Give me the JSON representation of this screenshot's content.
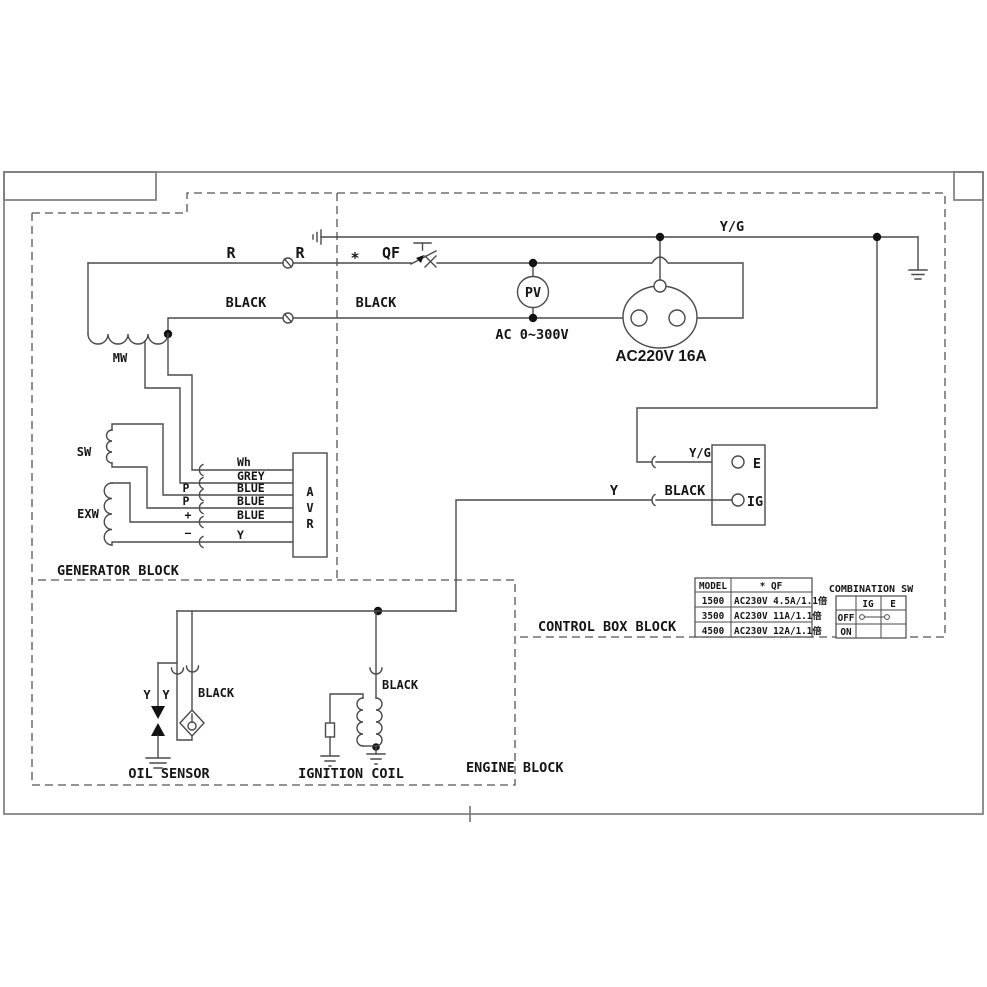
{
  "diagram": {
    "wire_labels": {
      "r_left": "R",
      "r_right": "R",
      "asterisk": "*",
      "qf": "QF",
      "black_left": "BLACK",
      "black_right": "BLACK",
      "yg_top": "Y/G"
    },
    "pv_meter": {
      "name": "PV",
      "range": "AC 0~300V"
    },
    "socket": {
      "rating": "AC220V 16A"
    },
    "generator_block": {
      "title": "GENERATOR BLOCK",
      "mw": "MW",
      "sw": "SW",
      "exw": "EXW",
      "avr_letters": [
        "A",
        "V",
        "R"
      ],
      "terminals": [
        "P",
        "P",
        "+",
        "−"
      ],
      "wires": [
        "Wh",
        "GREY",
        "BLUE",
        "BLUE",
        "BLUE",
        "Y"
      ]
    },
    "control_block": {
      "title": "CONTROL BOX BLOCK",
      "terminal_strip": {
        "e": "E",
        "ig": "IG",
        "e_wire": "Y/G",
        "ig_wire_y": "Y",
        "ig_wire_black": "BLACK"
      },
      "model_table": {
        "col1_header": "MODEL",
        "col2_header": "* QF",
        "rows": [
          {
            "model": "1500",
            "spec": "AC230V 4.5A/1.1倍"
          },
          {
            "model": "3500",
            "spec": "AC230V 11A/1.1倍"
          },
          {
            "model": "4500",
            "spec": "AC230V 12A/1.1倍"
          }
        ]
      },
      "combination_sw": {
        "title": "COMBINATION SW",
        "headers": [
          "IG",
          "E"
        ],
        "rows": [
          "OFF",
          "ON"
        ]
      }
    },
    "engine_block": {
      "title": "ENGINE BLOCK",
      "oil_sensor": {
        "label": "OIL SENSOR",
        "wire_y1": "Y",
        "wire_y2": "Y",
        "wire_black": "BLACK"
      },
      "ignition_coil": {
        "label": "IGNITION COIL",
        "wire_black": "BLACK"
      }
    }
  },
  "colors": {
    "line": "#4a4a4a",
    "frame": "#7d7d7d",
    "text": "#151515",
    "background": "#ffffff"
  }
}
